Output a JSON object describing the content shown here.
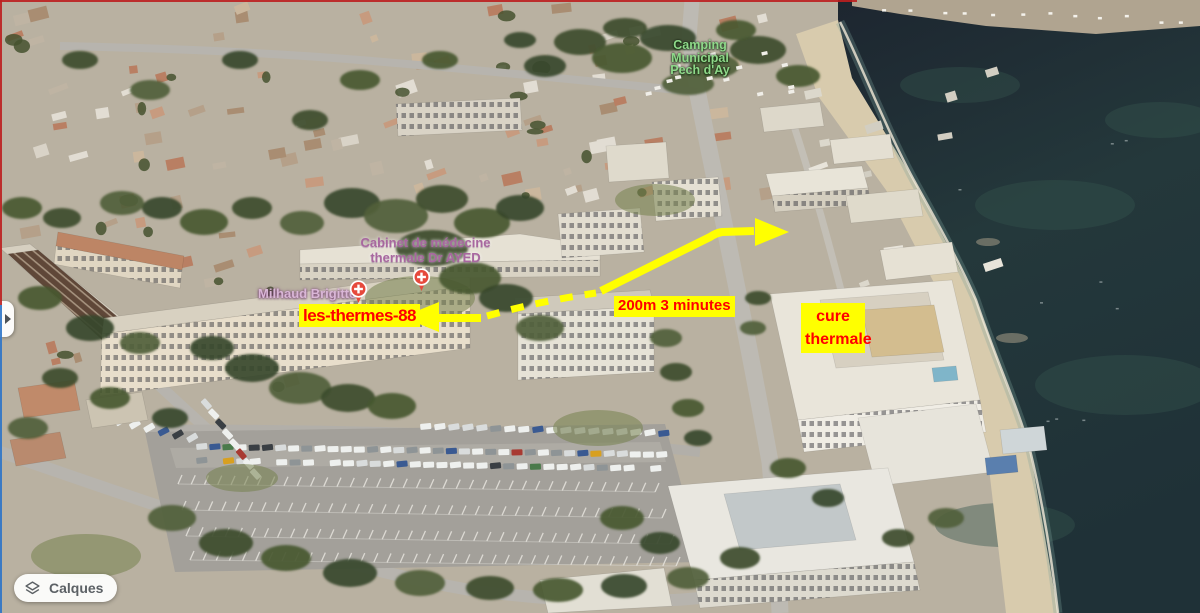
{
  "map_labels": {
    "camping": {
      "line1": "Camping",
      "line2": "Municipal",
      "line3": "Pech d'Ay",
      "color": "#8ed889"
    },
    "cabinet": {
      "line1": "Cabinet de médecine",
      "line2": "thermale Dr AYED",
      "color": "#a8679f"
    },
    "milhaud": {
      "text": "Milhaud Brigitte",
      "color": "#d9b6d6"
    }
  },
  "annotations": {
    "destination_label": {
      "text": "les-thermes-88",
      "text_color": "#ff0000",
      "bg_color": "#ffff00"
    },
    "route_label": {
      "text": "200m 3 minutes",
      "text_color": "#ff0000",
      "bg_color": "#ffff00"
    },
    "cure_label": {
      "line1": "cure",
      "line2": "thermale",
      "text_color": "#ff0000",
      "bg_color": "#ffff00"
    },
    "arrow_color": "#ffff00"
  },
  "controls": {
    "layers_button_label": "Calques"
  },
  "icons": {
    "layers_icon": "stacked-layers",
    "medical_pin_icon": "red-circle-white-cross",
    "expand_sidebar_icon": "right-pointing-triangle"
  },
  "colors": {
    "annotation_yellow": "#ffff00",
    "annotation_red": "#ff0000",
    "pin_red": "#e6493c",
    "sea": "#223238",
    "sand": "#d8cbad",
    "label_green": "#8ed889",
    "label_purple": "#a8679f",
    "button_text": "#5c6165"
  }
}
